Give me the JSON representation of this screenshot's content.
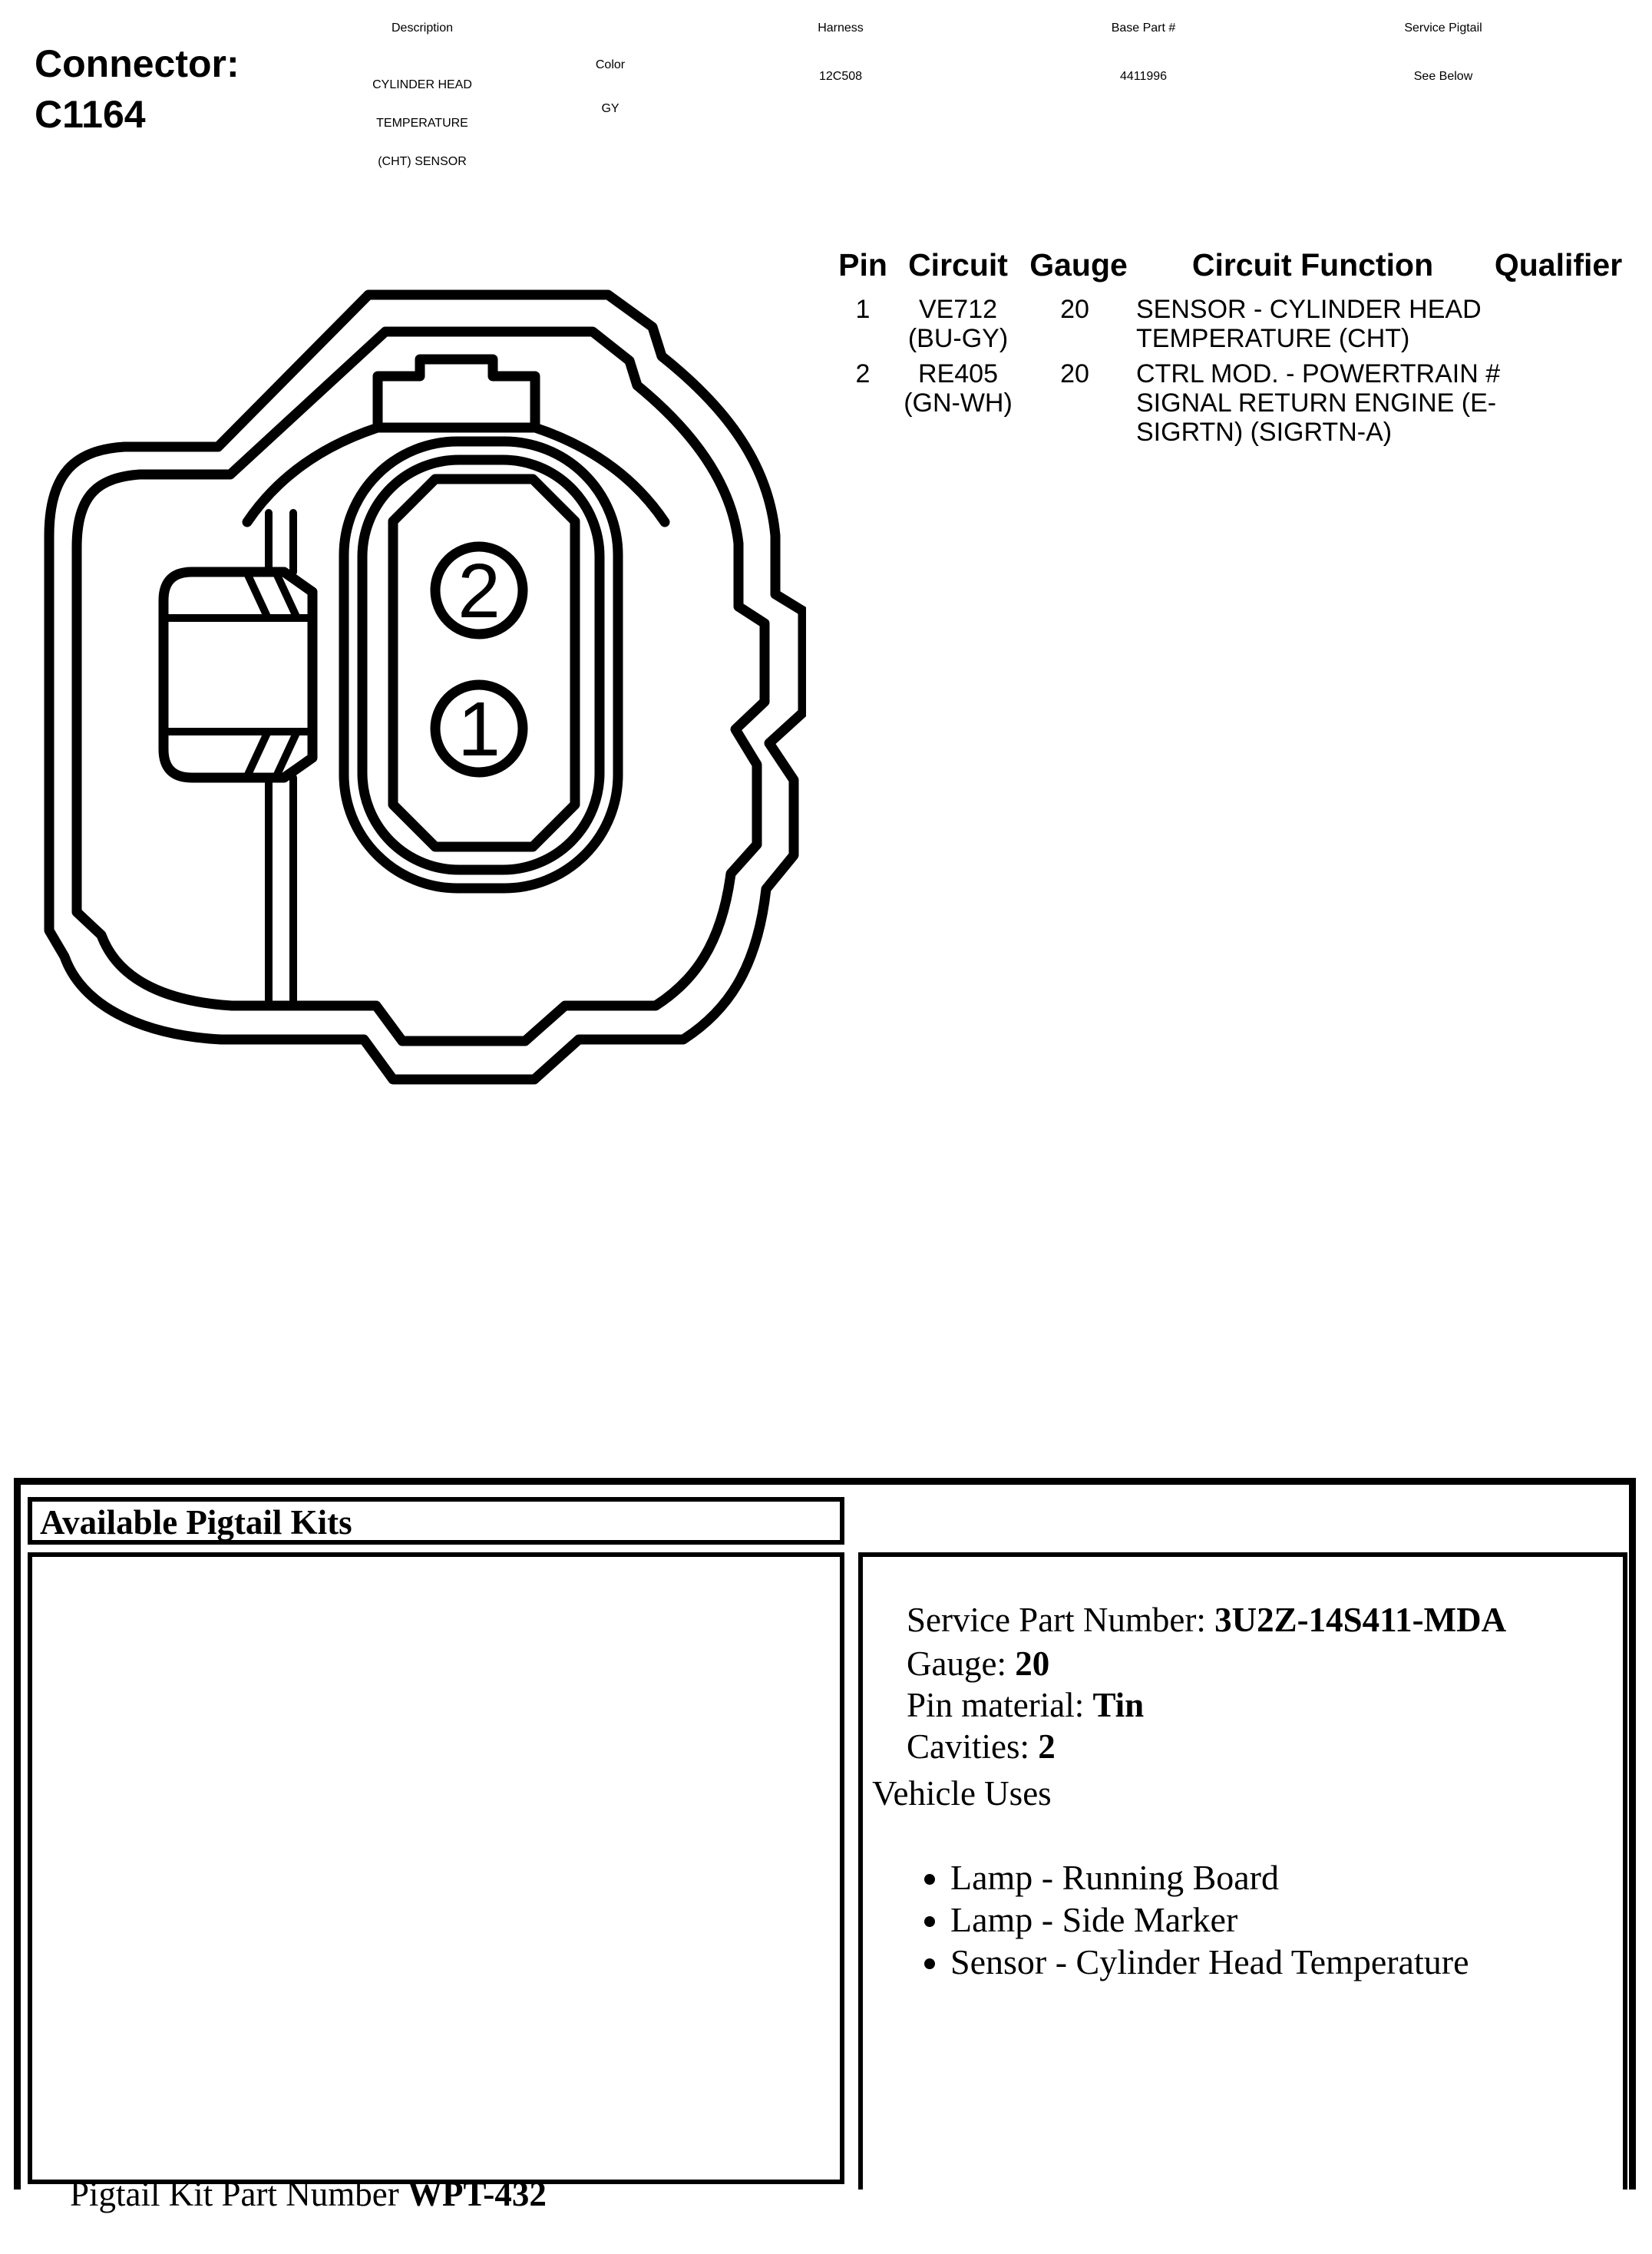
{
  "header": {
    "connector_label": "Connector:",
    "connector_id": "C1164",
    "columns": {
      "description": {
        "label": "Description",
        "lines": [
          "CYLINDER HEAD",
          "TEMPERATURE",
          "(CHT) SENSOR"
        ]
      },
      "color": {
        "label": "Color",
        "value": "GY"
      },
      "harness": {
        "label": "Harness",
        "value": "12C508"
      },
      "base_part": {
        "label": "Base Part #",
        "value": "4411996"
      },
      "service_pigtail": {
        "label": "Service Pigtail",
        "value": "See Below"
      }
    }
  },
  "pin_table": {
    "headers": {
      "pin": "Pin",
      "circuit": "Circuit",
      "gauge": "Gauge",
      "function": "Circuit Function",
      "qualifier": "Qualifier"
    },
    "rows": [
      {
        "pin": "1",
        "circuit": "VE712",
        "circuit_color": "(BU-GY)",
        "gauge": "20",
        "function_lines": [
          "SENSOR - CYLINDER HEAD",
          "TEMPERATURE (CHT)"
        ],
        "qualifier": ""
      },
      {
        "pin": "2",
        "circuit": "RE405",
        "circuit_color": "(GN-WH)",
        "gauge": "20",
        "function_lines": [
          "CTRL MOD. - POWERTRAIN #",
          "SIGNAL RETURN ENGINE (E-",
          "SIGRTN) (SIGRTN-A)"
        ],
        "qualifier": ""
      }
    ]
  },
  "diagram": {
    "cavity_labels": [
      "2",
      "1"
    ]
  },
  "pigtail": {
    "section_title": "Available Pigtail Kits",
    "kit_part_label": "Pigtail Kit Part Number ",
    "kit_part_number": "WPT-432",
    "details": {
      "service_part_label": "Service Part Number: ",
      "service_part_number": "3U2Z-14S411-MDA",
      "gauge_label": "Gauge: ",
      "gauge": "20",
      "pin_material_label": "Pin material: ",
      "pin_material": "Tin",
      "cavities_label": "Cavities: ",
      "cavities": "2",
      "vehicle_uses_label": "Vehicle Uses",
      "vehicle_uses": [
        "Lamp - Running Board",
        "Lamp - Side Marker",
        "Sensor - Cylinder Head Temperature"
      ]
    }
  },
  "colors": {
    "ink": "#000000",
    "paper": "#ffffff"
  }
}
